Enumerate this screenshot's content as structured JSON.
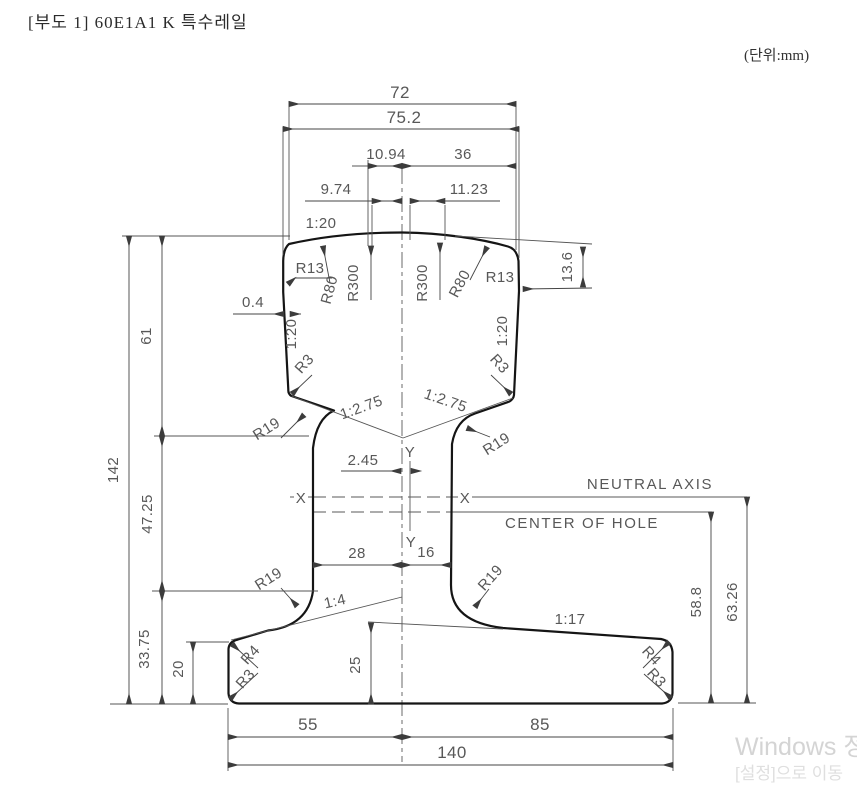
{
  "title": "[부도 1] 60E1A1 K 특수레일",
  "unit_label": "(단위:mm)",
  "labels": {
    "neutral_axis": "NEUTRAL AXIS",
    "center_of_hole": "CENTER OF HOLE",
    "axis_x": "X",
    "axis_y": "Y"
  },
  "dims": {
    "head_top_width": "72",
    "head_max_width": "75.2",
    "crown_left": "10.94",
    "crown_right": "36",
    "gauge_left": "9.74",
    "gauge_right": "11.23",
    "head_side_drop": "13.6",
    "side_offset": "0.4",
    "head_height": "61",
    "total_height": "142",
    "web_mid_height": "47.25",
    "foot_zone_height": "33.75",
    "axis_offset": "2.45",
    "web_left_width": "28",
    "web_right_width": "16",
    "foot_edge_height": "20",
    "foot_mid_height": "25",
    "foot_left_width": "55",
    "foot_right_width": "85",
    "foot_total_width": "140",
    "hole_center_height": "58.8",
    "neutral_axis_height": "63.26"
  },
  "radii": {
    "r13": "R13",
    "r80": "R80",
    "r300": "R300",
    "r3": "R3",
    "r19": "R19",
    "r4": "R4"
  },
  "slopes": {
    "top": "1:20",
    "head_under": "1:2.75",
    "foot_left": "1:4",
    "foot_right": "1:17"
  },
  "watermark": {
    "line1": "Windows 정",
    "line2": "[설정]으로 이동"
  }
}
